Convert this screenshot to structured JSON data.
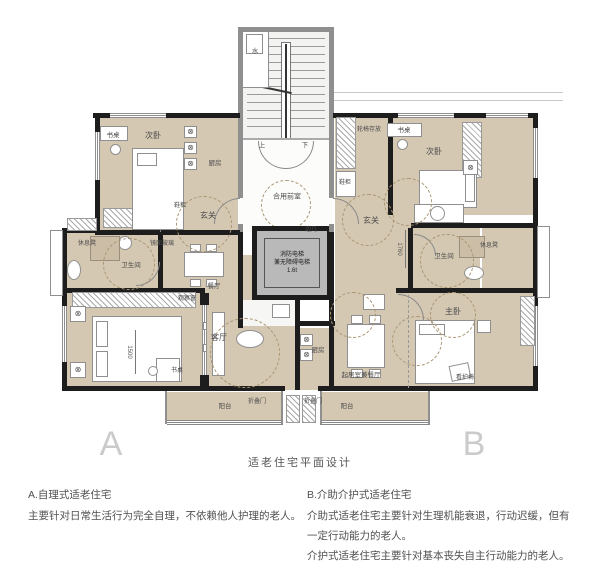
{
  "title": "适老住宅平面设计",
  "glyphs": {
    "fan": "⊗"
  },
  "plan": {
    "core": {
      "water": "水",
      "up": "上",
      "down": "下",
      "lobby": "合用前室",
      "elev1": "消防电梯",
      "elev2": "兼无障碍电梯",
      "elev3": "1.6t"
    },
    "unit_a": {
      "letter": "A",
      "desk": "书桌",
      "bedroom2": "次卧",
      "kitchen": "厨房",
      "shoe": "鞋柜",
      "entry": "玄关",
      "mirror": "镜面玻璃",
      "bench": "休息凳",
      "bath": "卫生间",
      "dining": "餐厅",
      "obs_window": "观察窗",
      "living": "客厅",
      "balcony": "阳台",
      "fold": "折叠门",
      "dim_bed": "1500"
    },
    "unit_b": {
      "letter": "B",
      "wheelchair": "轮椅存放",
      "desk": "书桌",
      "bedroom2": "次卧",
      "shoe": "鞋柜",
      "entry": "玄关",
      "side_table": "边几",
      "bench": "休息凳",
      "bath": "卫生间",
      "master": "主卧",
      "care_chair": "看护椅",
      "kitchen": "厨房",
      "living_dining": "起居室兼餐厅",
      "balcony": "阳台",
      "fold": "折叠门",
      "dim_entry": "1760"
    }
  },
  "captions": {
    "a_title": "A.自理式适老住宅",
    "a_body": "主要针对日常生活行为完全自理，不依赖他人护理的老人。",
    "b_title": "B.介助介护式适老住宅",
    "b_body1": "介助式适老住宅主要针对生理机能衰退，行动迟缓，但有一定行动能力的老人。",
    "b_body2": "介护式适老住宅主要针对基本丧失自主行动能力的老人。"
  },
  "colors": {
    "floor": "#d5c8b3",
    "wall": "#1d1d1d",
    "wall_gray": "#8f8f8f",
    "turning_circle": "#ab9572",
    "text": "#4a4a4a",
    "unit_letter": "#cbcbcb"
  }
}
